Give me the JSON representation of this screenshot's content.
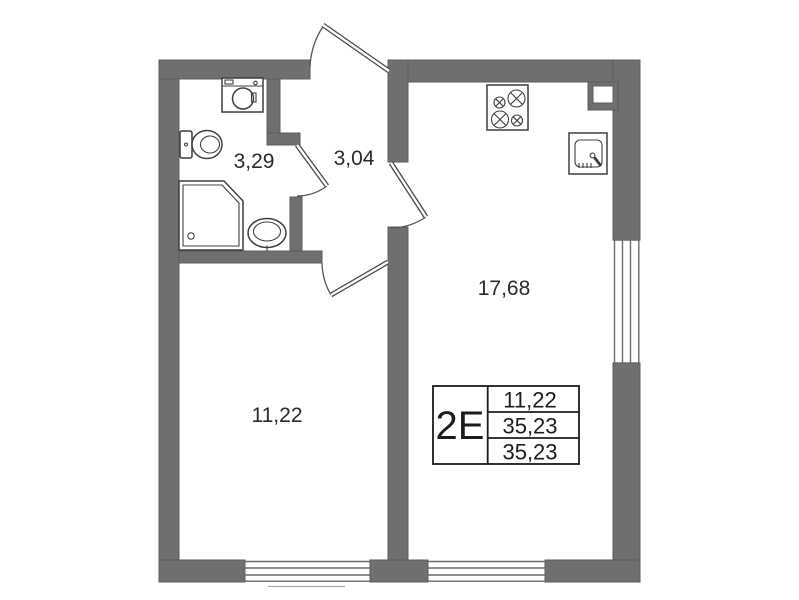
{
  "floor_plan": {
    "unit_type": "2E",
    "areas": {
      "bathroom": "3,29",
      "hallway": "3,04",
      "kitchen_living": "17,68",
      "room": "11,22"
    },
    "info_table": {
      "unit_type": "2E",
      "row1": "11,22",
      "row2": "35,23",
      "row3": "35,23"
    },
    "colors": {
      "wall": "#6f6f6f",
      "fixture_outline": "#3f3f3f",
      "text": "#2b2b2b"
    }
  }
}
